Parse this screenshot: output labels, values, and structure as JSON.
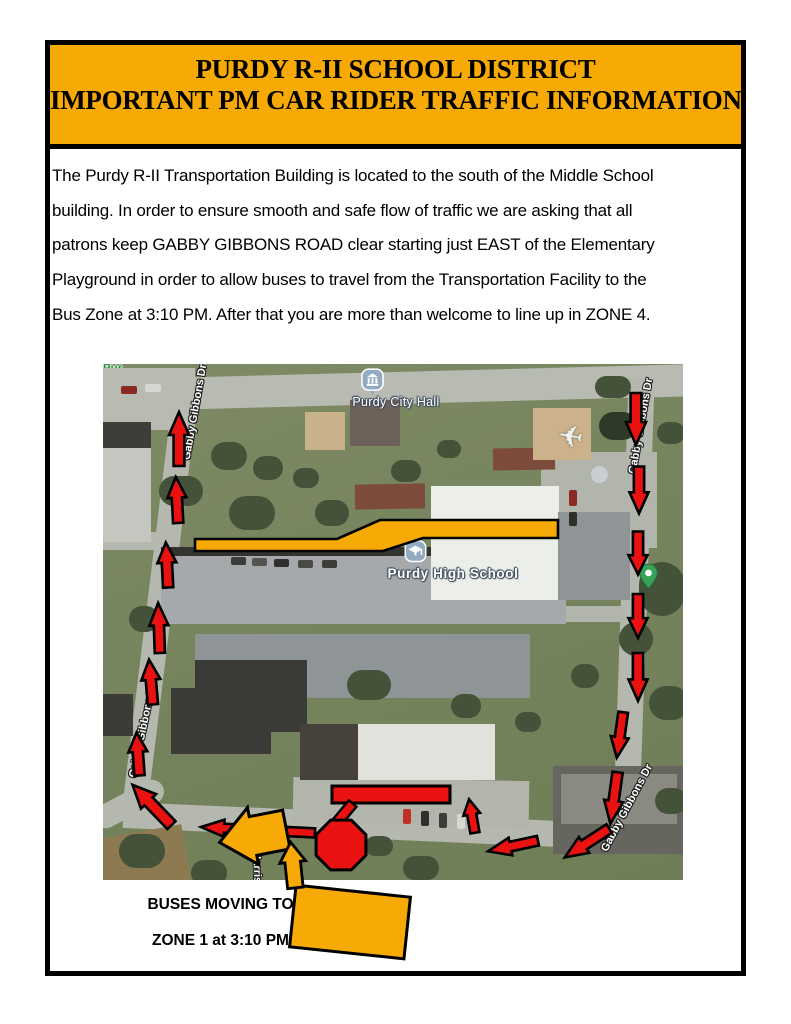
{
  "banner": {
    "line1": "PURDY R-II SCHOOL DISTRICT",
    "line2": "IMPORTANT PM CAR RIDER TRAFFIC INFORMATION",
    "bg": "#F7A906"
  },
  "body": {
    "lines": [
      "The Purdy R-II Transportation Building is located to the south of the Middle School",
      "building.  In order to ensure smooth and safe flow of traffic we are asking that all",
      "patrons keep GABBY GIBBONS ROAD clear starting just EAST of the Elementary",
      "Playground in order to allow buses to travel from the Transportation Facility to the",
      "Bus Zone at 3:10 PM.  After that you are more than welcome to line up in ZONE 4."
    ]
  },
  "caption": {
    "line1": "BUSES MOVING TO",
    "line2": "ZONE 1 at 3:10 PM"
  },
  "map": {
    "pois": {
      "city_hall": "Purdy City Hall",
      "high_school": "Purdy High School",
      "green_line1": "Pur",
      "green_line2": "Bas"
    },
    "road_labels": [
      {
        "text": "Gabby Gibbons Dr",
        "x": 92,
        "y": 48,
        "a": -80
      },
      {
        "text": "Gabby Gibbons Dr",
        "x": 538,
        "y": 62,
        "a": -80
      },
      {
        "text": "Gabby Gibbons Dr",
        "x": 40,
        "y": 366,
        "a": -78
      },
      {
        "text": "Gabby Gibbons Dr",
        "x": 524,
        "y": 444,
        "a": -62
      },
      {
        "text": "Harrison",
        "x": 154,
        "y": 510,
        "a": 88
      }
    ],
    "colors": {
      "gold": "#F7A906",
      "red": "#EA1111",
      "outline": "#000000",
      "poi_green": "#2D8E41"
    },
    "overlay": {
      "yellow_band_points": "92,175 234,175 277,156 455,156 455,174 320,174 280,187 92,187",
      "red_bar": {
        "x": 229,
        "y": 422,
        "w": 118,
        "h": 17
      },
      "stop_sign": {
        "cx": 238,
        "cy": 481,
        "r": 27
      },
      "stem": {
        "cx": 240,
        "cy": 451,
        "w": 10,
        "h": 30,
        "rot": 40
      },
      "red_arrows": [
        {
          "x": 76,
          "y": 75,
          "l": 54,
          "w": 20,
          "a": 0
        },
        {
          "x": 74,
          "y": 136,
          "l": 46,
          "w": 19,
          "a": -3
        },
        {
          "x": 64,
          "y": 201,
          "l": 45,
          "w": 19,
          "a": -3
        },
        {
          "x": 56,
          "y": 264,
          "l": 50,
          "w": 19,
          "a": -2
        },
        {
          "x": 48,
          "y": 318,
          "l": 45,
          "w": 19,
          "a": -5
        },
        {
          "x": 35,
          "y": 390,
          "l": 43,
          "w": 19,
          "a": -4
        },
        {
          "x": 49,
          "y": 441,
          "l": 56,
          "w": 21,
          "a": -44
        },
        {
          "x": 155,
          "y": 466,
          "l": 114,
          "w": 17,
          "a": -87
        },
        {
          "x": 533,
          "y": 55,
          "l": 52,
          "w": 20,
          "a": 180
        },
        {
          "x": 536,
          "y": 126,
          "l": 47,
          "w": 19,
          "a": 180
        },
        {
          "x": 535,
          "y": 189,
          "l": 43,
          "w": 19,
          "a": 180
        },
        {
          "x": 535,
          "y": 252,
          "l": 44,
          "w": 19,
          "a": 180
        },
        {
          "x": 535,
          "y": 313,
          "l": 48,
          "w": 19,
          "a": 180
        },
        {
          "x": 517,
          "y": 371,
          "l": 46,
          "w": 18,
          "a": 188
        },
        {
          "x": 511,
          "y": 434,
          "l": 52,
          "w": 19,
          "a": 188
        },
        {
          "x": 484,
          "y": 479,
          "l": 53,
          "w": 19,
          "a": 237
        },
        {
          "x": 410,
          "y": 482,
          "l": 51,
          "w": 18,
          "a": 258
        },
        {
          "x": 369,
          "y": 452,
          "l": 34,
          "w": 17,
          "a": -10
        }
      ],
      "big_yellow_arrow": {
        "x": 150,
        "y": 472,
        "l": 68,
        "w": 58,
        "a": -101,
        "hl": 34,
        "sf": 0.34
      },
      "small_yellow_arrow": {
        "x": 190,
        "y": 501,
        "l": 46,
        "w": 26,
        "a": -6,
        "hl": 20,
        "sf": 0.3
      },
      "bus_rect": {
        "cx": 247,
        "cy": 558,
        "w": 115,
        "h": 62,
        "rot": 6
      }
    }
  }
}
